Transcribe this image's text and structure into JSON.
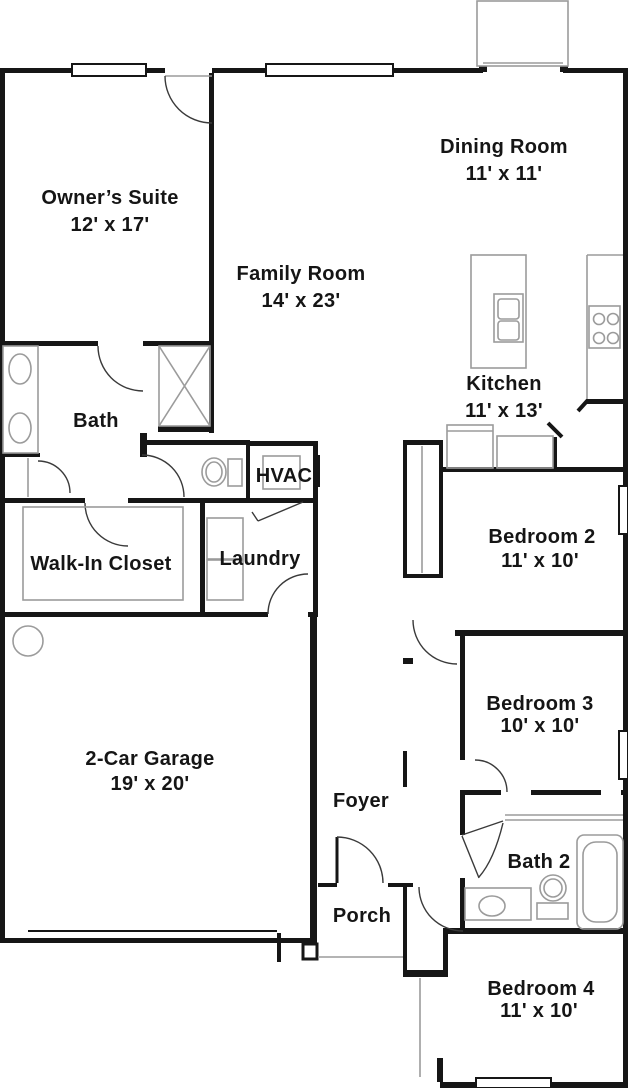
{
  "plan": {
    "title": "Single-story house floor plan",
    "colors": {
      "wall": "#161616",
      "fixture": "#9b9b9b",
      "background": "#ffffff",
      "text": "#151515"
    },
    "rooms": [
      {
        "name": "Owner’s Suite",
        "dims": "12' x 17'"
      },
      {
        "name": "Dining Room",
        "dims": "11' x 11'"
      },
      {
        "name": "Family Room",
        "dims": "14' x 23'"
      },
      {
        "name": "Kitchen",
        "dims": "11' x 13'"
      },
      {
        "name": "Bath"
      },
      {
        "name": "HVAC"
      },
      {
        "name": "Walk-In Closet"
      },
      {
        "name": "Laundry"
      },
      {
        "name": "Bedroom 2",
        "dims": "11' x 10'"
      },
      {
        "name": "Bedroom 3",
        "dims": "10' x 10'"
      },
      {
        "name": "2-Car Garage",
        "dims": "19' x 20'"
      },
      {
        "name": "Foyer"
      },
      {
        "name": "Bath 2"
      },
      {
        "name": "Porch"
      },
      {
        "name": "Bedroom 4",
        "dims": "11' x 10'"
      }
    ]
  }
}
